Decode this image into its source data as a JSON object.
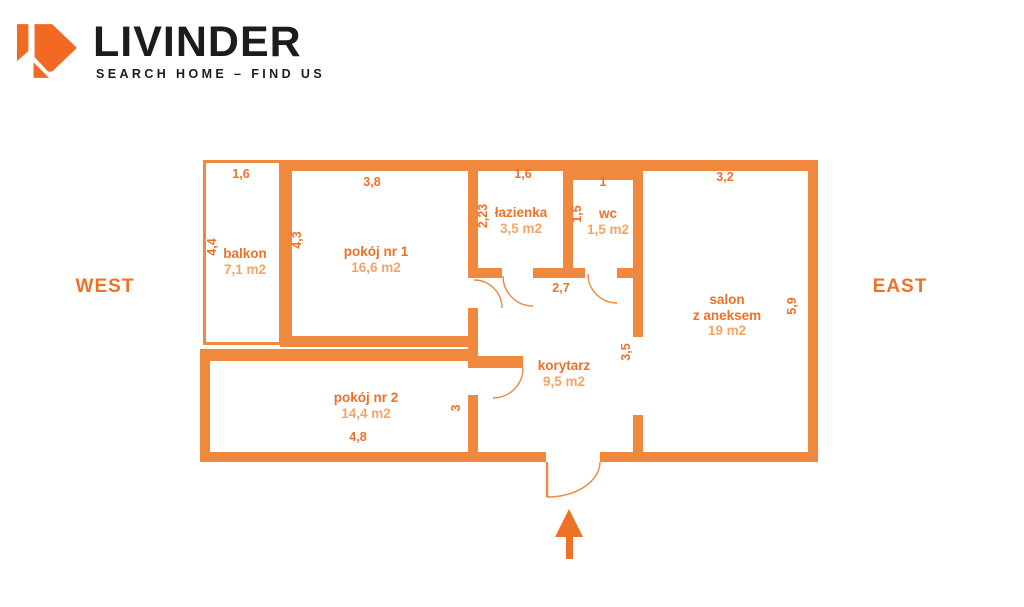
{
  "brand": {
    "name": "LIVINDER",
    "tagline": "SEARCH HOME – FIND US",
    "logo_icon": "arrow-d-logo"
  },
  "compass": {
    "west": "WEST",
    "east": "EAST"
  },
  "colors": {
    "wall": "#f0883e",
    "label_strong": "#ed7228",
    "label_light": "#f4a566",
    "logo": "#f26a21",
    "text": "#1c1c1b"
  },
  "floorplan": {
    "rooms": [
      {
        "id": "balkon",
        "lines": [
          "balkon"
        ],
        "area": "7,1 m2",
        "x": 245,
        "y": 246
      },
      {
        "id": "pokoj-1",
        "lines": [
          "pokój nr 1"
        ],
        "area": "16,6 m2",
        "x": 376,
        "y": 244
      },
      {
        "id": "lazienka",
        "lines": [
          "łazienka"
        ],
        "area": "3,5 m2",
        "x": 521,
        "y": 205
      },
      {
        "id": "wc",
        "lines": [
          "wc"
        ],
        "area": "1,5 m2",
        "x": 608,
        "y": 206
      },
      {
        "id": "salon",
        "lines": [
          "salon",
          "z aneksem"
        ],
        "area": "19 m2",
        "x": 727,
        "y": 292
      },
      {
        "id": "korytarz",
        "lines": [
          "korytarz"
        ],
        "area": "9,5 m2",
        "x": 564,
        "y": 358
      },
      {
        "id": "pokoj-2",
        "lines": [
          "pokój nr 2"
        ],
        "area": "14,4 m2",
        "x": 366,
        "y": 390
      }
    ],
    "dimensions": [
      {
        "value": "1,6",
        "x": 241,
        "y": 174,
        "rotated": false
      },
      {
        "value": "3,8",
        "x": 372,
        "y": 182,
        "rotated": false
      },
      {
        "value": "1,6",
        "x": 523,
        "y": 174,
        "rotated": false
      },
      {
        "value": "1",
        "x": 603,
        "y": 182,
        "rotated": false
      },
      {
        "value": "3,2",
        "x": 725,
        "y": 177,
        "rotated": false
      },
      {
        "value": "2,7",
        "x": 561,
        "y": 288,
        "rotated": false
      },
      {
        "value": "4,8",
        "x": 358,
        "y": 437,
        "rotated": false
      },
      {
        "value": "4,4",
        "x": 212,
        "y": 247,
        "rotated": true
      },
      {
        "value": "4,3",
        "x": 297,
        "y": 240,
        "rotated": true
      },
      {
        "value": "2,23",
        "x": 483,
        "y": 216,
        "rotated": true
      },
      {
        "value": "1,5",
        "x": 577,
        "y": 214,
        "rotated": true
      },
      {
        "value": "5,9",
        "x": 792,
        "y": 306,
        "rotated": true
      },
      {
        "value": "3,5",
        "x": 626,
        "y": 352,
        "rotated": true
      },
      {
        "value": "3",
        "x": 456,
        "y": 408,
        "rotated": true
      }
    ]
  }
}
